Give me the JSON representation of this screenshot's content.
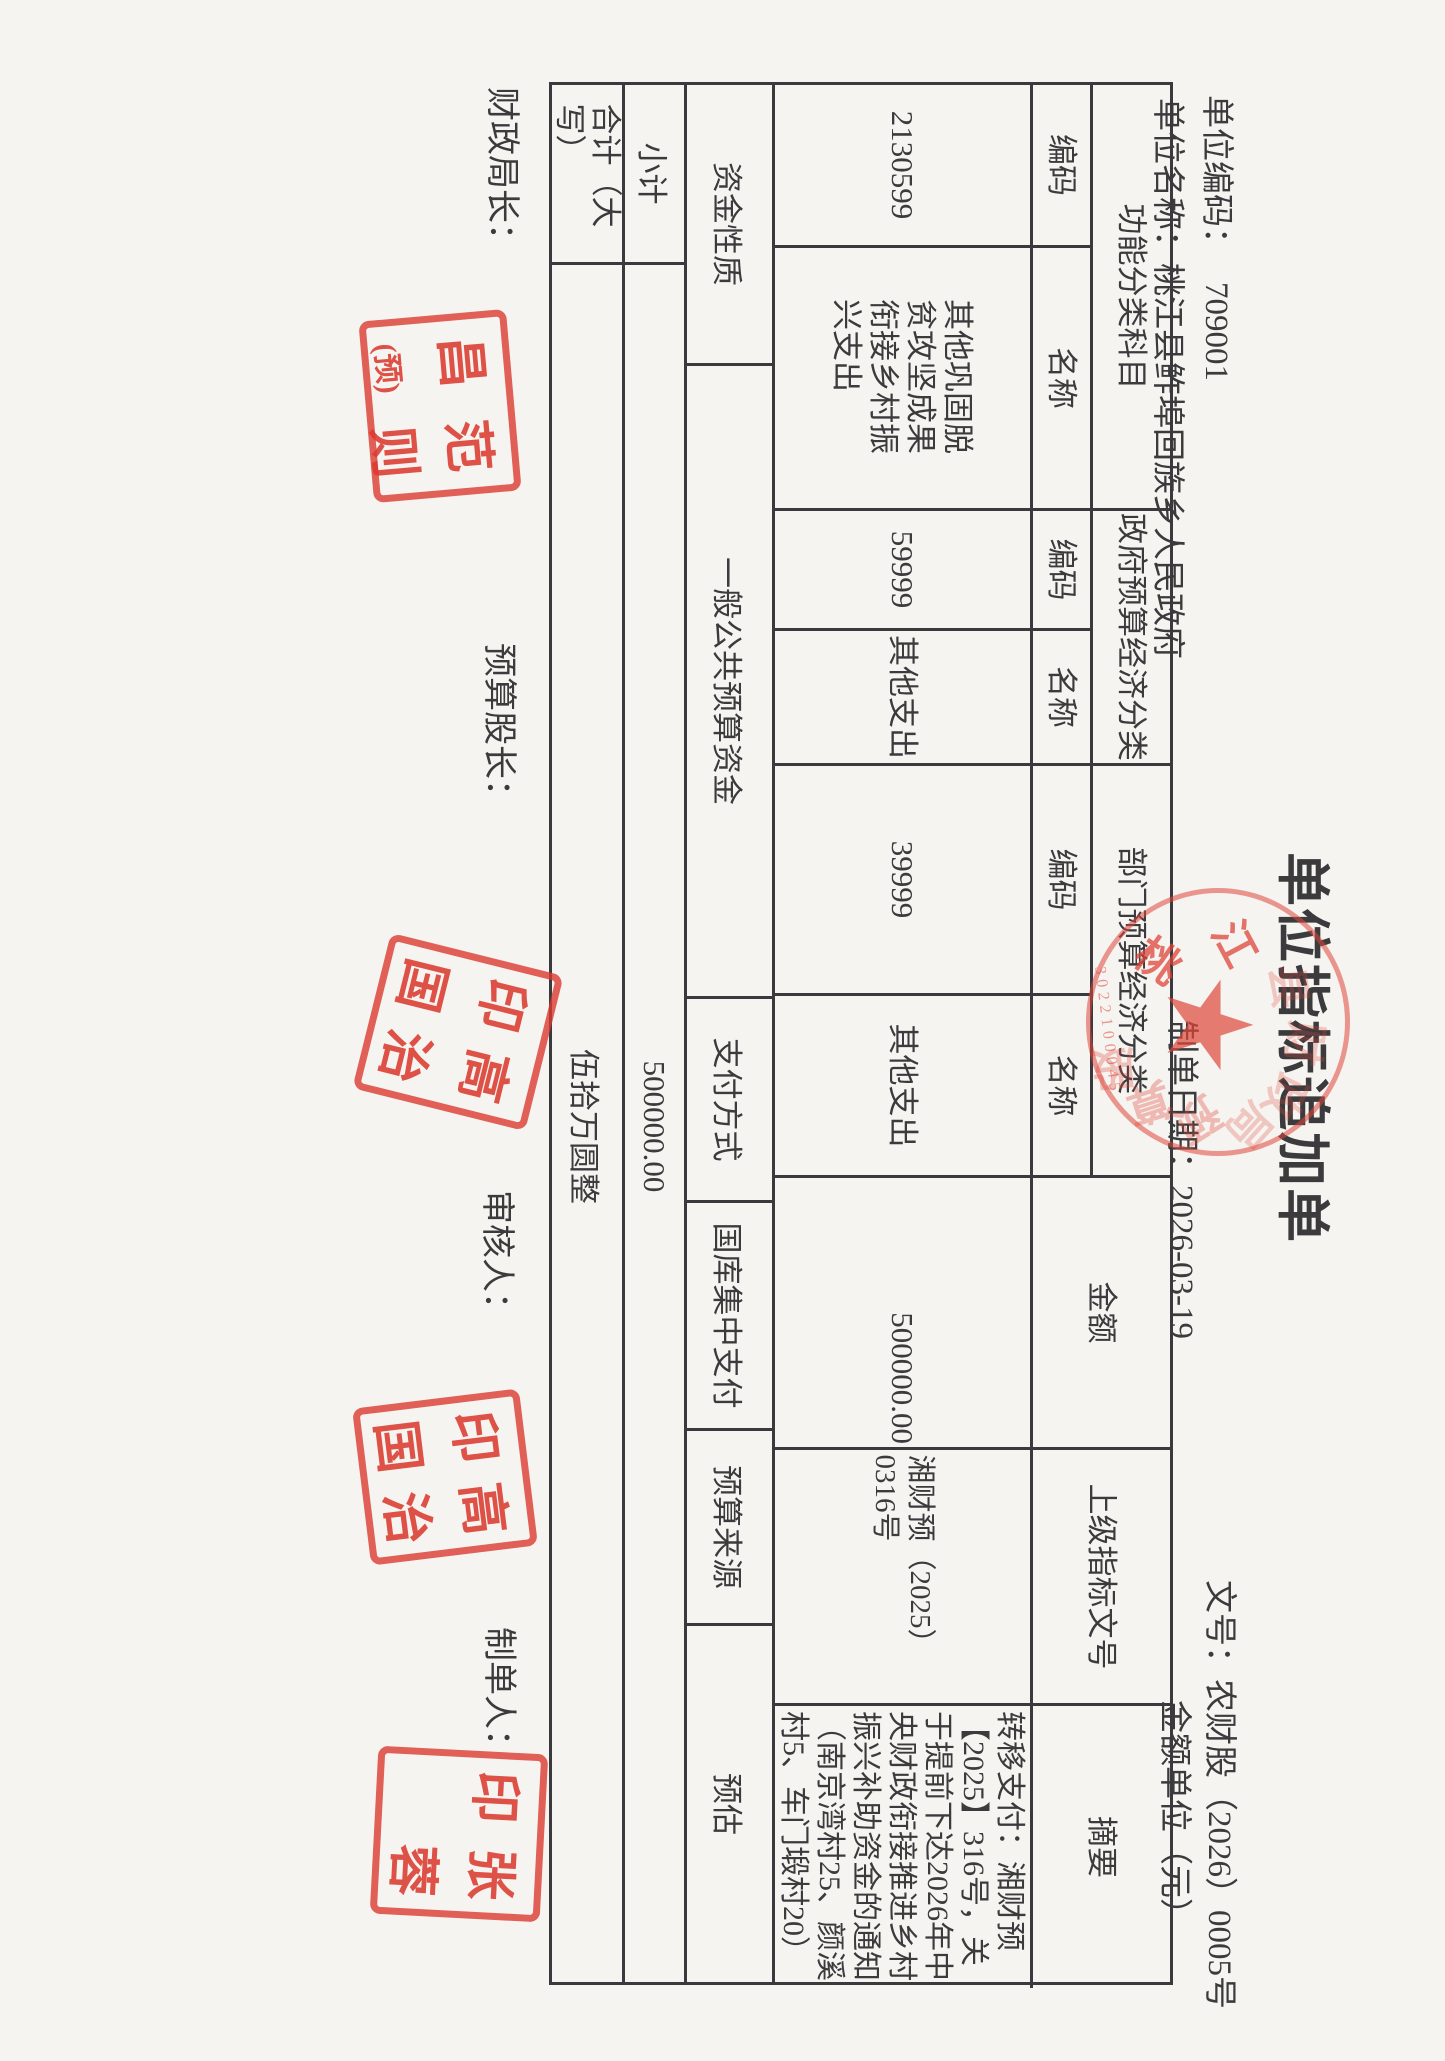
{
  "colors": {
    "paper": "#f6f4f0",
    "ink": "#3b3b3e",
    "red": "#db3a2f"
  },
  "header": {
    "title": "单位指标追加单",
    "unit_code_label": "单位编码：",
    "unit_code_value": "709001",
    "unit_name_label": "单位名称：",
    "unit_name_value": "桃江县鲊埠回族乡人民政府",
    "doc_no_label": "文号：",
    "doc_no_value": "农财股（2026）0005号",
    "make_date_label": "制单日期：",
    "make_date_value": "2026-03-19",
    "amount_unit": "金额单位（元）"
  },
  "table": {
    "groups": {
      "func": "功能分类科目",
      "gov": "政府预算经济分类",
      "dept": "部门预算经济分类"
    },
    "sub": {
      "code": "编码",
      "name": "名称"
    },
    "cols": {
      "amount": "金额",
      "doc_ref": "上级指标文号",
      "summary": "摘要"
    },
    "data": {
      "func_code": "2130599",
      "func_name": "其他巩固脱贫攻坚成果衔接乡村振兴支出",
      "gov_code": "59999",
      "gov_name": "其他支出",
      "dept_code": "39999",
      "dept_name": "其他支出",
      "amount": "500000.00",
      "doc_ref": "湘财预（2025）0316号",
      "summary": "转移支付：湘财预【2025】316号，关于提前下达2026年中央财政衔接推进乡村振兴补助资金的通知（南京湾村25、颜溪村5、车门塅村20）"
    },
    "fund_row": {
      "fund_label": "资金性质",
      "fund_value": "一般公共预算资金",
      "pay_label": "支付方式",
      "pay_value": "国库集中支付",
      "source_label": "预算来源",
      "source_value": "预估"
    },
    "subtotal": {
      "label": "小计",
      "value": "500000.00"
    },
    "total": {
      "label": "合计（大写）",
      "value": "伍拾万圆整"
    }
  },
  "footer": {
    "sign1": "财政局长：",
    "sign2": "预算股长：",
    "sign3": "审核人：",
    "sign4": "制单人："
  },
  "stamps": {
    "seal_a": {
      "c1": "昌",
      "c2": "范",
      "c3": "(预)",
      "c4": "则"
    },
    "seal_b": {
      "c1": "印",
      "c2": "高",
      "c3": "国",
      "c4": "治"
    },
    "seal_c": {
      "c1": "印",
      "c2": "张",
      "c3": "",
      "c4": "蓉"
    },
    "round": {
      "t1": "桃",
      "t2": "江",
      "t3": "县",
      "t4": "财",
      "t5": "政",
      "t6": "局",
      "t7": "预",
      "t8": "算",
      "t9": "股",
      "star": "★",
      "serial": "3022100045"
    }
  }
}
